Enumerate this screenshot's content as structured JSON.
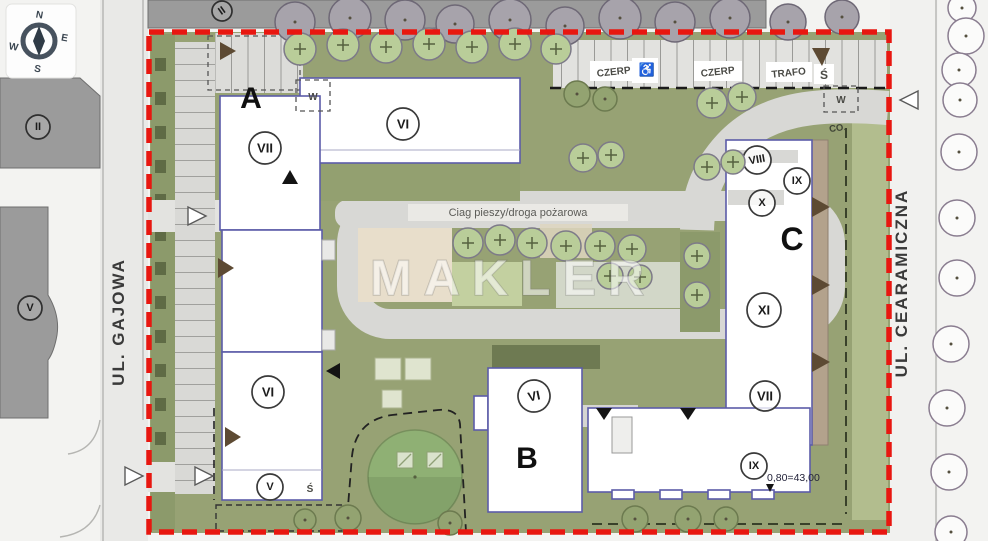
{
  "compass": {
    "n": "N",
    "e": "E",
    "s": "S",
    "w": "W"
  },
  "streets": {
    "left": "UL. GAJOWA",
    "right": "UL. CEARAMICZNA"
  },
  "watermark": "MAKLER",
  "site": {
    "path_label": "Ciag pieszy/droga pożarowa",
    "parking": {
      "czerp_1": "CZERP",
      "accessible": "♿",
      "czerp_2": "CZERP",
      "trafo": "TRAFO",
      "s": "Ś"
    },
    "utility": {
      "w_left": "W",
      "w_right": "W",
      "co": "CO."
    },
    "level_note": "0,80=43,00"
  },
  "buildings": {
    "a": {
      "letter": "A",
      "wing_top": "VI",
      "tower": "VII",
      "mid": "VI",
      "low": "V",
      "s": "Ś"
    },
    "b": {
      "letter": "B",
      "floors": "VI"
    },
    "c": {
      "letter": "C",
      "top": "VIII",
      "ix_top": "IX",
      "x": "X",
      "xi": "XI",
      "vii": "VII",
      "ix_bottom": "IX"
    }
  },
  "existing": {
    "top": "II",
    "left_upper": "II",
    "left_lower": "V"
  },
  "colors": {
    "boundary": "#e81710",
    "building_outline": "#5c5ca8",
    "lawn": "#97a274",
    "road": "#d8d8d5",
    "tree": "#b9cd99",
    "beige": "#e8decb",
    "existing_building": "#9b9b9b",
    "marker_brown": "#5d4a33"
  }
}
